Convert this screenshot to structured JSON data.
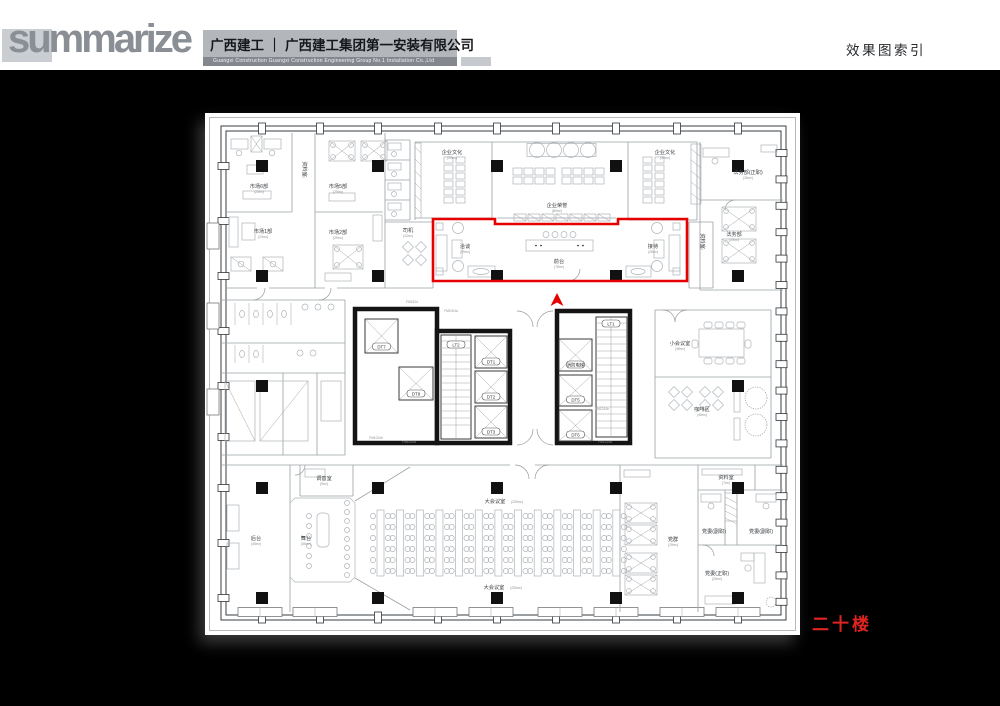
{
  "header": {
    "logo_text": "summarize",
    "company_cn": "广西建工 ｜ 广西建工集团第一安装有限公司",
    "company_en": "Guangxi Construction      Guangxi Construction Engineering Group No.1 Installation Co.,Ltd",
    "page_title": "效果图索引"
  },
  "floor_label": "二十楼",
  "colors": {
    "highlight": "#e60000",
    "floor_text": "#e02520",
    "paper": "#ffffff",
    "background": "#000000"
  },
  "plan": {
    "rooms": [
      {
        "label": "市场6部",
        "sub": "(23m²)"
      },
      {
        "label": "市场5部",
        "sub": "(29m²)"
      },
      {
        "label": "市场1部",
        "sub": "(23m²)"
      },
      {
        "label": "市场2部",
        "sub": "(29m²)"
      },
      {
        "label": "资料室",
        "sub": "(7m²)"
      },
      {
        "label": "司机",
        "sub": "(12m²)"
      },
      {
        "label": "企业文化",
        "sub": "(23m²)"
      },
      {
        "label": "企业荣誉",
        "sub": "(80m²)"
      },
      {
        "label": "企业文化",
        "sub": "(30m²)"
      },
      {
        "label": "法务部(正职)",
        "sub": "(26m²)"
      },
      {
        "label": "法务部",
        "sub": "(25m²)"
      },
      {
        "label": "资料室",
        "sub": "(7m²)"
      },
      {
        "label": "洽谈",
        "sub": "(25m²)"
      },
      {
        "label": "前台",
        "sub": "(78m²)"
      },
      {
        "label": "接待",
        "sub": "(25m²)"
      },
      {
        "label": "小会议室",
        "sub": "(48m²)"
      },
      {
        "label": "咖啡区",
        "sub": "(45m²)"
      },
      {
        "label": "调音室",
        "sub": "(9m²)"
      },
      {
        "label": "后台",
        "sub": "(45m²)"
      },
      {
        "label": "舞台",
        "sub": "(56m²)"
      },
      {
        "label": "大会议室",
        "sub": "(230m²)"
      },
      {
        "label": "大会议室",
        "sub": "(230m²)"
      },
      {
        "label": "党群",
        "sub": "(25m²)"
      },
      {
        "label": "资料室",
        "sub": "(7m²)"
      },
      {
        "label": "党委(副职)",
        "sub": ""
      },
      {
        "label": "党委(副职)",
        "sub": ""
      },
      {
        "label": "党委(正职)",
        "sub": "(26m²)"
      }
    ],
    "core": {
      "cabs": [
        "DT7",
        "DT8",
        "DT1",
        "DT2",
        "DT3",
        "消防电梯",
        "DT5",
        "DT6"
      ],
      "stairs": [
        "LT2",
        "LT1"
      ],
      "door_codes": [
        "FM1524",
        "FM1024a",
        "FM1024b",
        "FM1224a",
        "FM1224b"
      ]
    }
  }
}
